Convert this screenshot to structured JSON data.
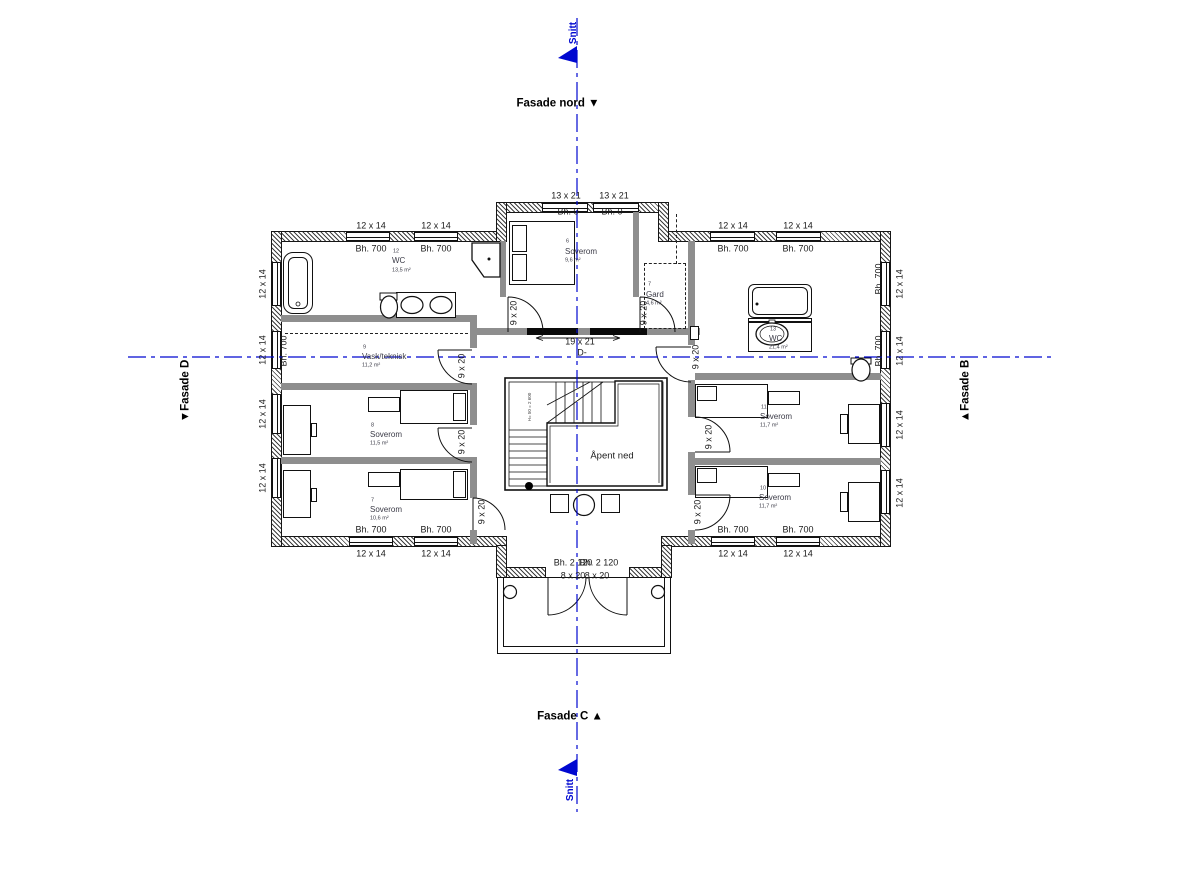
{
  "drawing": {
    "type": "floor-plan",
    "facades": [
      "Fasade nord",
      "Fasade B",
      "Fasade C",
      "Fasade D"
    ],
    "section_label": "Snitt",
    "stair_void_label": "Åpent ned"
  },
  "colors": {
    "section_blue": "#0008d0",
    "wall_black": "#161616",
    "room_text": "#3a3a46"
  },
  "rooms": [
    {
      "number": "12",
      "name": "WC",
      "area": "13,5 m²"
    },
    {
      "number": "6",
      "name": "Soverom",
      "area": "9,6 m²"
    },
    {
      "number": "7",
      "name": "Gard",
      "area": "4,6 m²"
    },
    {
      "number": "9",
      "name": "Vask/teknisk",
      "area": "11,2 m²"
    },
    {
      "number": "8",
      "name": "Soverom",
      "area": "11,5 m²"
    },
    {
      "number": "7",
      "name": "Soverom",
      "area": "10,6 m²"
    },
    {
      "number": "13",
      "name": "WC",
      "area": "21,4 m²"
    },
    {
      "number": "11",
      "name": "Soverom",
      "area": "11,7 m²"
    },
    {
      "number": "10",
      "name": "Soverom",
      "area": "11,7 m²"
    }
  ],
  "labels": [
    {
      "n": "label-fasade-nord",
      "t": "Fasade nord ▼",
      "x": 558,
      "y": 104,
      "c": "facade"
    },
    {
      "n": "label-fasade-c",
      "t": "Fasade C ▲",
      "x": 570,
      "y": 717,
      "c": "facade"
    },
    {
      "n": "label-fasade-d",
      "t": "▼Fasade D",
      "x": 186,
      "y": 391,
      "r": -90,
      "c": "facade"
    },
    {
      "n": "label-fasade-b",
      "t": "▲Fasade B",
      "x": 966,
      "y": 391,
      "r": -90,
      "c": "facade"
    },
    {
      "n": "label-snitt-top",
      "t": "Snitt",
      "x": 574,
      "y": 33,
      "r": -90,
      "c": "snitt"
    },
    {
      "n": "label-snitt-bottom",
      "t": "Snitt",
      "x": 571,
      "y": 790,
      "r": -90,
      "c": "snitt"
    },
    {
      "n": "dim-window",
      "t": "12 x 14",
      "x": 371,
      "y": 226,
      "c": "dim"
    },
    {
      "n": "dim-window",
      "t": "12 x 14",
      "x": 436,
      "y": 226,
      "c": "dim"
    },
    {
      "n": "dim-sill",
      "t": "Bh. 700",
      "x": 371,
      "y": 249,
      "c": "dim"
    },
    {
      "n": "dim-sill",
      "t": "Bh. 700",
      "x": 436,
      "y": 249,
      "c": "dim"
    },
    {
      "n": "dim-window",
      "t": "12 x 14",
      "x": 733,
      "y": 226,
      "c": "dim"
    },
    {
      "n": "dim-window",
      "t": "12 x 14",
      "x": 798,
      "y": 226,
      "c": "dim"
    },
    {
      "n": "dim-sill",
      "t": "Bh. 700",
      "x": 733,
      "y": 249,
      "c": "dim"
    },
    {
      "n": "dim-sill",
      "t": "Bh. 700",
      "x": 798,
      "y": 249,
      "c": "dim"
    },
    {
      "n": "dim-window",
      "t": "13 x 21",
      "x": 566,
      "y": 196,
      "c": "dim"
    },
    {
      "n": "dim-window",
      "t": "13 x 21",
      "x": 614,
      "y": 196,
      "c": "dim"
    },
    {
      "n": "dim-sill",
      "t": "Bh. 0",
      "x": 568,
      "y": 212,
      "c": "dim"
    },
    {
      "n": "dim-sill",
      "t": "Bh. 0",
      "x": 612,
      "y": 212,
      "c": "dim"
    },
    {
      "n": "dim-sill",
      "t": "Bh. 700",
      "x": 371,
      "y": 530,
      "c": "dim"
    },
    {
      "n": "dim-sill",
      "t": "Bh. 700",
      "x": 436,
      "y": 530,
      "c": "dim"
    },
    {
      "n": "dim-window",
      "t": "12 x 14",
      "x": 371,
      "y": 554,
      "c": "dim"
    },
    {
      "n": "dim-window",
      "t": "12 x 14",
      "x": 436,
      "y": 554,
      "c": "dim"
    },
    {
      "n": "dim-sill",
      "t": "Bh. 700",
      "x": 733,
      "y": 530,
      "c": "dim"
    },
    {
      "n": "dim-sill",
      "t": "Bh. 700",
      "x": 798,
      "y": 530,
      "c": "dim"
    },
    {
      "n": "dim-window",
      "t": "12 x 14",
      "x": 733,
      "y": 554,
      "c": "dim"
    },
    {
      "n": "dim-window",
      "t": "12 x 14",
      "x": 798,
      "y": 554,
      "c": "dim"
    },
    {
      "n": "dim-window",
      "t": "12 x 14",
      "x": 263,
      "y": 284,
      "r": -90,
      "c": "dim"
    },
    {
      "n": "dim-window",
      "t": "12 x 14",
      "x": 263,
      "y": 350,
      "r": -90,
      "c": "dim"
    },
    {
      "n": "dim-window",
      "t": "12 x 14",
      "x": 263,
      "y": 414,
      "r": -90,
      "c": "dim"
    },
    {
      "n": "dim-window",
      "t": "12 x 14",
      "x": 263,
      "y": 478,
      "r": -90,
      "c": "dim"
    },
    {
      "n": "dim-sill",
      "t": "Bh. 700",
      "x": 284,
      "y": 351,
      "r": -90,
      "c": "dim"
    },
    {
      "n": "dim-window",
      "t": "12 x 14",
      "x": 900,
      "y": 284,
      "r": -90,
      "c": "dim"
    },
    {
      "n": "dim-window",
      "t": "12 x 14",
      "x": 900,
      "y": 351,
      "r": -90,
      "c": "dim"
    },
    {
      "n": "dim-window",
      "t": "12 x 14",
      "x": 900,
      "y": 425,
      "r": -90,
      "c": "dim"
    },
    {
      "n": "dim-window",
      "t": "12 x 14",
      "x": 900,
      "y": 493,
      "r": -90,
      "c": "dim"
    },
    {
      "n": "dim-sill",
      "t": "Bh. 700",
      "x": 879,
      "y": 279,
      "r": -90,
      "c": "dim"
    },
    {
      "n": "dim-sill",
      "t": "Bh. 700",
      "x": 879,
      "y": 351,
      "r": -90,
      "c": "dim"
    },
    {
      "n": "dim-door",
      "t": "9 x 20",
      "x": 514,
      "y": 313,
      "r": -90,
      "c": "dim"
    },
    {
      "n": "dim-door",
      "t": "9 x 20",
      "x": 644,
      "y": 313,
      "r": -90,
      "c": "dim"
    },
    {
      "n": "dim-door",
      "t": "9 x 20",
      "x": 696,
      "y": 357,
      "r": -90,
      "c": "dim"
    },
    {
      "n": "dim-door",
      "t": "9 x 20",
      "x": 462,
      "y": 366,
      "r": -90,
      "c": "dim"
    },
    {
      "n": "dim-door",
      "t": "9 x 20",
      "x": 462,
      "y": 442,
      "r": -90,
      "c": "dim"
    },
    {
      "n": "dim-door",
      "t": "9 x 20",
      "x": 482,
      "y": 512,
      "r": -90,
      "c": "dim"
    },
    {
      "n": "dim-door",
      "t": "9 x 20",
      "x": 709,
      "y": 437,
      "r": -90,
      "c": "dim"
    },
    {
      "n": "dim-door",
      "t": "9 x 20",
      "x": 698,
      "y": 512,
      "r": -90,
      "c": "dim"
    },
    {
      "n": "dim-opening",
      "t": "19 x 21",
      "x": 580,
      "y": 342,
      "c": "dim"
    },
    {
      "n": "dim-opening-id",
      "t": "D-",
      "x": 582,
      "y": 353,
      "c": "dim"
    },
    {
      "n": "dim-sill",
      "t": "Bh. 2 120",
      "x": 573,
      "y": 563,
      "c": "dim"
    },
    {
      "n": "dim-sill",
      "t": "Bh. 2 120",
      "x": 599,
      "y": 563,
      "c": "dim"
    },
    {
      "n": "dim-door",
      "t": "8 x 20",
      "x": 573,
      "y": 576,
      "c": "dim"
    },
    {
      "n": "dim-door",
      "t": "8 x 20",
      "x": 597,
      "y": 576,
      "c": "dim"
    },
    {
      "n": "label-apent-ned",
      "t": "Åpent ned",
      "x": 612,
      "y": 456,
      "c": "open"
    },
    {
      "n": "label-stair-note",
      "t": "H= 50 = 2 600",
      "x": 530,
      "y": 407,
      "r": -90,
      "c": "tiny"
    },
    {
      "n": "room-number",
      "t": "12",
      "x": 393,
      "y": 252,
      "c": "rnum",
      "a": "l"
    },
    {
      "n": "room-name",
      "t": "WC",
      "x": 392,
      "y": 261,
      "c": "rname",
      "a": "l"
    },
    {
      "n": "room-area",
      "t": "13,5 m²",
      "x": 392,
      "y": 271,
      "c": "rarea",
      "a": "l"
    },
    {
      "n": "room-number",
      "t": "6",
      "x": 566,
      "y": 242,
      "c": "rnum",
      "a": "l"
    },
    {
      "n": "room-name",
      "t": "Soverom",
      "x": 565,
      "y": 252,
      "c": "rname",
      "a": "l"
    },
    {
      "n": "room-area",
      "t": "9,6 m²",
      "x": 565,
      "y": 261,
      "c": "rarea",
      "a": "l"
    },
    {
      "n": "room-number",
      "t": "7",
      "x": 648,
      "y": 285,
      "c": "rnum",
      "a": "l"
    },
    {
      "n": "room-name",
      "t": "Gard",
      "x": 646,
      "y": 295,
      "c": "rname",
      "a": "l"
    },
    {
      "n": "room-area",
      "t": "4,6 m²",
      "x": 646,
      "y": 304,
      "c": "rarea",
      "a": "l"
    },
    {
      "n": "room-number",
      "t": "9",
      "x": 363,
      "y": 348,
      "c": "rnum",
      "a": "l"
    },
    {
      "n": "room-name",
      "t": "Vask/teknisk",
      "x": 362,
      "y": 357,
      "c": "rname",
      "a": "l"
    },
    {
      "n": "room-area",
      "t": "11,2 m²",
      "x": 362,
      "y": 366,
      "c": "rarea",
      "a": "l"
    },
    {
      "n": "room-number",
      "t": "8",
      "x": 371,
      "y": 426,
      "c": "rnum",
      "a": "l"
    },
    {
      "n": "room-name",
      "t": "Soverom",
      "x": 370,
      "y": 435,
      "c": "rname",
      "a": "l"
    },
    {
      "n": "room-area",
      "t": "11,5 m²",
      "x": 370,
      "y": 444,
      "c": "rarea",
      "a": "l"
    },
    {
      "n": "room-number",
      "t": "7",
      "x": 371,
      "y": 501,
      "c": "rnum",
      "a": "l"
    },
    {
      "n": "room-name",
      "t": "Soverom",
      "x": 370,
      "y": 510,
      "c": "rname",
      "a": "l"
    },
    {
      "n": "room-area",
      "t": "10,6 m²",
      "x": 370,
      "y": 519,
      "c": "rarea",
      "a": "l"
    },
    {
      "n": "room-number",
      "t": "13",
      "x": 770,
      "y": 330,
      "c": "rnum",
      "a": "l"
    },
    {
      "n": "room-name",
      "t": "WC",
      "x": 769,
      "y": 339,
      "c": "rname",
      "a": "l"
    },
    {
      "n": "room-area",
      "t": "21,4 m²",
      "x": 769,
      "y": 348,
      "c": "rarea",
      "a": "l"
    },
    {
      "n": "room-number",
      "t": "11",
      "x": 761,
      "y": 408,
      "c": "rnum",
      "a": "l"
    },
    {
      "n": "room-name",
      "t": "Soverom",
      "x": 760,
      "y": 417,
      "c": "rname",
      "a": "l"
    },
    {
      "n": "room-area",
      "t": "11,7 m²",
      "x": 760,
      "y": 426,
      "c": "rarea",
      "a": "l"
    },
    {
      "n": "room-number",
      "t": "10",
      "x": 760,
      "y": 489,
      "c": "rnum",
      "a": "l"
    },
    {
      "n": "room-name",
      "t": "Soverom",
      "x": 759,
      "y": 498,
      "c": "rname",
      "a": "l"
    },
    {
      "n": "room-area",
      "t": "11,7 m²",
      "x": 759,
      "y": 507,
      "c": "rarea",
      "a": "l"
    }
  ]
}
